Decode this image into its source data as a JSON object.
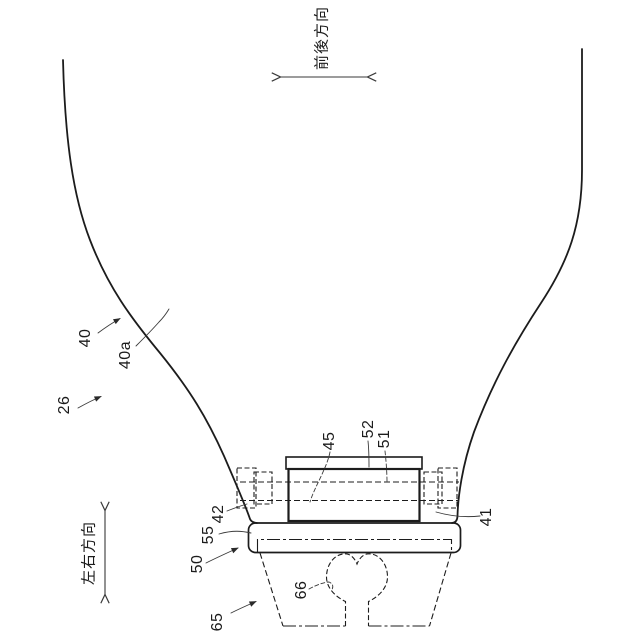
{
  "figure": {
    "kind": "patent-line-drawing",
    "colors": {
      "background": "#ffffff",
      "line": "#1c1c1c",
      "leader": "#3a3a3a"
    },
    "reference_numerals": [
      "26",
      "40",
      "40a",
      "41",
      "42",
      "45",
      "50",
      "51",
      "52",
      "55",
      "65",
      "66"
    ],
    "direction_indicators": [
      {
        "label": "前後方向",
        "axis": "horizontal-double-arrow"
      },
      {
        "label": "左右方向",
        "axis": "vertical-double-arrow"
      }
    ]
  },
  "labels": {
    "front_back": "前後方向",
    "left_right": "左右方向",
    "n26": "26",
    "n40": "40",
    "n40a": "40a",
    "n41": "41",
    "n42": "42",
    "n45": "45",
    "n50": "50",
    "n51": "51",
    "n52": "52",
    "n55": "55",
    "n65": "65",
    "n66": "66"
  }
}
